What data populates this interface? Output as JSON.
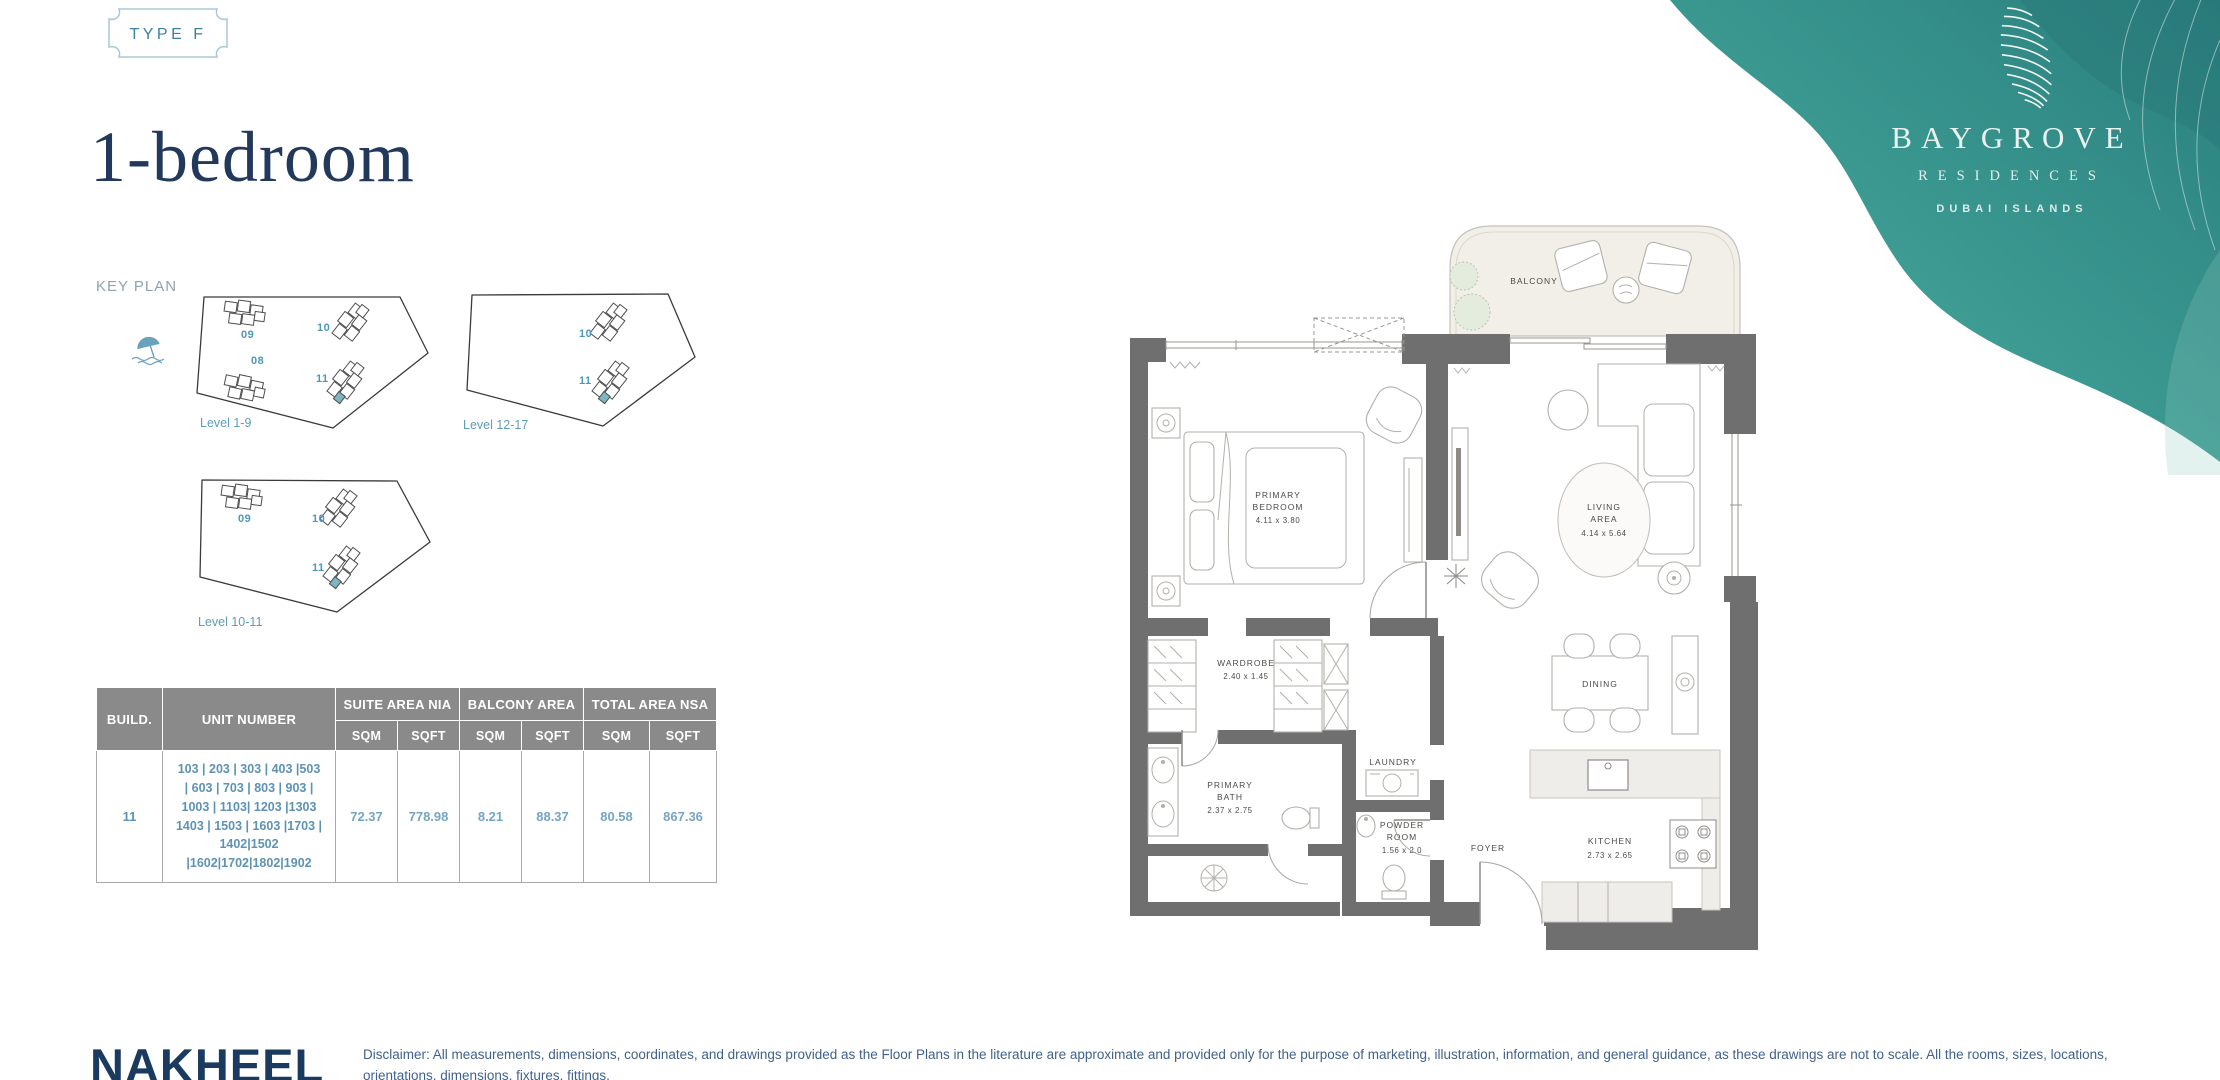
{
  "badge": {
    "label": "TYPE F"
  },
  "title": "1-bedroom",
  "key_plan": {
    "label": "KEY PLAN",
    "plans": [
      {
        "level": "Level 1-9",
        "buildings": [
          "09",
          "10",
          "08",
          "11"
        ]
      },
      {
        "level": "Level 12-17",
        "buildings": [
          "10",
          "11"
        ]
      },
      {
        "level": "Level 10-11",
        "buildings": [
          "09",
          "10",
          "11"
        ]
      }
    ]
  },
  "table": {
    "headers": {
      "build": "BUILD.",
      "unit": "UNIT NUMBER",
      "suite": "SUITE AREA NIA",
      "balcony": "BALCONY AREA",
      "total": "TOTAL AREA NSA"
    },
    "sub": [
      "SQM",
      "SQFT",
      "SQM",
      "SQFT",
      "SQM",
      "SQFT"
    ],
    "row": {
      "build": "11",
      "units": "103 | 203 | 303 |  403 |503\n| 603 | 703 | 803 | 903 |\n1003 | 1103| 1203 |1303\n1403 | 1503 | 1603 |1703 |\n1402|1502\n|1602|1702|1802|1902",
      "values": [
        "72.37",
        "778.98",
        "8.21",
        "88.37",
        "80.58",
        "867.36"
      ]
    }
  },
  "floor_plan": {
    "balcony": "BALCONY",
    "bedroom_l1": "PRIMARY",
    "bedroom_l2": "BEDROOM",
    "bedroom_dims": "4.11 x 3.80",
    "living_l1": "LIVING",
    "living_l2": "AREA",
    "living_dims": "4.14 x 5.64",
    "wardrobe": "WARDROBE",
    "wardrobe_dims": "2.40 x 1.45",
    "bath_l1": "PRIMARY",
    "bath_l2": "BATH",
    "bath_dims": "2.37 x 2.75",
    "laundry": "LAUNDRY",
    "powder_l1": "POWDER",
    "powder_l2": "ROOM",
    "powder_dims": "1.56 x 2.0",
    "foyer": "FOYER",
    "dining": "DINING",
    "kitchen": "KITCHEN",
    "kitchen_dims": "2.73 x 2.65"
  },
  "logo": {
    "name": "BAYGROVE",
    "sub": "RESIDENCES",
    "place": "DUBAI ISLANDS",
    "teal": "#3c9a92"
  },
  "footer": {
    "brand": "NAKHEEL",
    "disclaimer": "Disclaimer: All measurements, dimensions, coordinates, and drawings provided as the Floor Plans in the literature are approximate and provided only for the purpose of marketing, illustration, information, and general guidance, as these drawings are not to scale. All the rooms, sizes, locations, orientations, dimensions, fixtures, fittings,\nfinishes, and specifications (including materials, placement, size of rooms, windows, doors, balconies, and built-in wardrobes) provided in the floor plans may vary as the same have been taken from concept designs prior the actual development/construction. Therefore, their accuracy in relation to the completed construction cannot be"
  }
}
